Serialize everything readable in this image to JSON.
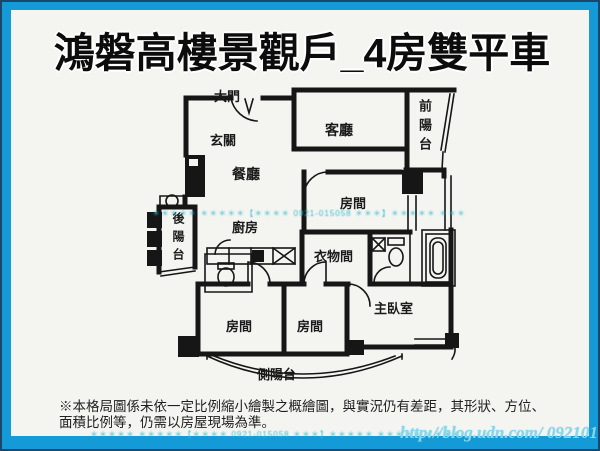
{
  "window": {
    "title": "鴻磐高樓景觀戶_4房雙平車"
  },
  "floorplan": {
    "labels": [
      {
        "id": "main-door",
        "text": "大門",
        "x": 212,
        "y": 84,
        "size": 13,
        "vertical": false
      },
      {
        "id": "entry",
        "text": "玄關",
        "x": 208,
        "y": 128,
        "size": 13,
        "vertical": false
      },
      {
        "id": "living-room",
        "text": "客廳",
        "x": 323,
        "y": 118,
        "size": 14,
        "vertical": false
      },
      {
        "id": "front-balcony",
        "text": "前陽台",
        "x": 413,
        "y": 97,
        "size": 13,
        "vertical": true
      },
      {
        "id": "dining-room",
        "text": "餐廳",
        "x": 230,
        "y": 162,
        "size": 14,
        "vertical": false
      },
      {
        "id": "bedroom-1",
        "text": "房間",
        "x": 338,
        "y": 191,
        "size": 13,
        "vertical": false
      },
      {
        "id": "back-balcony",
        "text": "後陽台",
        "x": 168,
        "y": 210,
        "size": 12,
        "vertical": true
      },
      {
        "id": "kitchen",
        "text": "廚房",
        "x": 230,
        "y": 215,
        "size": 13,
        "vertical": false
      },
      {
        "id": "closet-room",
        "text": "衣物間",
        "x": 312,
        "y": 244,
        "size": 13,
        "vertical": false
      },
      {
        "id": "master-bedroom",
        "text": "主臥室",
        "x": 372,
        "y": 296,
        "size": 13,
        "vertical": false
      },
      {
        "id": "bedroom-2",
        "text": "房間",
        "x": 224,
        "y": 314,
        "size": 13,
        "vertical": false
      },
      {
        "id": "bedroom-3",
        "text": "房間",
        "x": 295,
        "y": 314,
        "size": 13,
        "vertical": false
      },
      {
        "id": "side-balcony",
        "text": "側陽台",
        "x": 255,
        "y": 362,
        "size": 13,
        "vertical": false
      }
    ]
  },
  "watermarks": {
    "strip": "＊＊＊＊＊ ＊＊＊＊＊【＊＊＊＊ 0921-015058 ＊＊＊】＊＊＊＊＊ ＊＊＊＊＊ ＊＊＊＊",
    "url": "http://blog.udn.com/ 0921015058"
  },
  "disclaimer": {
    "line1": "※本格局圖係未依一定比例縮小繪製之概繪圖，與實況仍有差距，其形狀、方位、",
    "line2": "面積比例等，仍需以房屋現場為準。"
  },
  "colors": {
    "frame_blue": "#149bd7",
    "frame_edge": "#1e4668",
    "paper": "#f4f4f1",
    "wall": "#161616",
    "watermark_cyan": "#26bad0"
  }
}
